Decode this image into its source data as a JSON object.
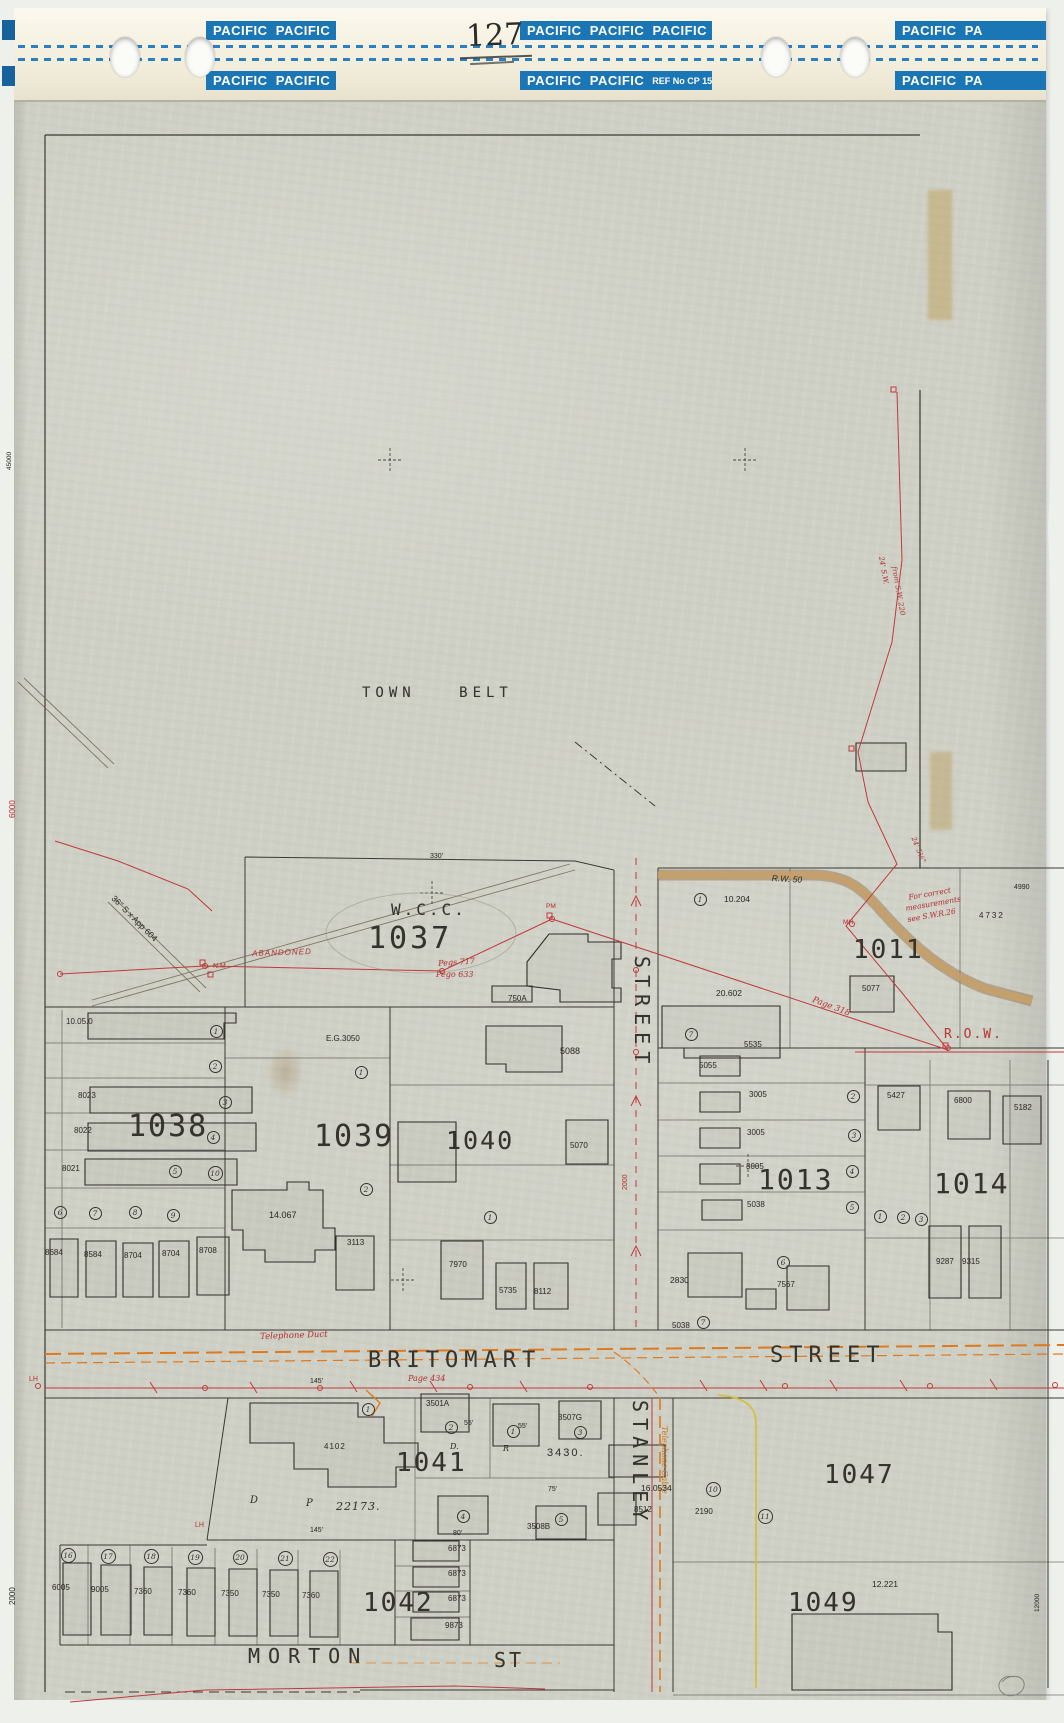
{
  "tape": {
    "page_number": "127",
    "boxes": [
      {
        "label": "PACIFIC  PACIFIC",
        "x": 192,
        "y": 13,
        "w": 130
      },
      {
        "label": "PACIFIC  PACIFIC  PACIFIC",
        "x": 506,
        "y": 13,
        "w": 192
      },
      {
        "label": "PACIFIC  PA",
        "x": 881,
        "y": 13,
        "w": 151
      },
      {
        "label": "PACIFIC  PACIFIC",
        "x": 192,
        "y": 63,
        "w": 130
      },
      {
        "label": "PACIFIC  PACIFIC",
        "x": 506,
        "y": 63,
        "w": 192,
        "ref": "REF No CP 15"
      },
      {
        "label": "PACIFIC  PA",
        "x": 881,
        "y": 63,
        "w": 151
      }
    ]
  },
  "colors": {
    "k": "#34332d",
    "r": "#c0393c",
    "o": "#dd7a20",
    "tape_blue": "#1b76b5",
    "tan_road": "#c7a068",
    "yellow_line": "#d4bf35",
    "paper": "#cfd0c5"
  },
  "map": {
    "labels": [
      {
        "t": "TOWN BELT",
        "x": 362,
        "y": 686,
        "s": 14,
        "f": "m",
        "ls": 5,
        "ws": 30,
        "dn": "region-label-town-belt"
      },
      {
        "t": "W.C.C.",
        "x": 391,
        "y": 902,
        "s": 16,
        "f": "m",
        "ls": 3,
        "dn": "block-label-wcc"
      },
      {
        "t": "1037",
        "x": 368,
        "y": 924,
        "s": 30,
        "f": "m",
        "ls": 3,
        "dn": "block-label-1037"
      },
      {
        "t": "1038",
        "x": 128,
        "y": 1112,
        "s": 30,
        "f": "m",
        "ls": 2,
        "dn": "block-label-1038"
      },
      {
        "t": "1039",
        "x": 314,
        "y": 1122,
        "s": 30,
        "f": "m",
        "ls": 2,
        "dn": "block-label-1039"
      },
      {
        "t": "1040",
        "x": 446,
        "y": 1128,
        "s": 25,
        "f": "m",
        "ls": 2,
        "dn": "block-label-1040"
      },
      {
        "t": "1011",
        "x": 853,
        "y": 937,
        "s": 26,
        "f": "m",
        "ls": 2,
        "dn": "block-label-1011"
      },
      {
        "t": "1013",
        "x": 758,
        "y": 1166,
        "s": 28,
        "f": "m",
        "ls": 2,
        "dn": "block-label-1013"
      },
      {
        "t": "1014",
        "x": 934,
        "y": 1170,
        "s": 28,
        "f": "m",
        "ls": 2,
        "dn": "block-label-1014"
      },
      {
        "t": "1041",
        "x": 396,
        "y": 1450,
        "s": 26,
        "f": "m",
        "ls": 2,
        "dn": "block-label-1041"
      },
      {
        "t": "1047",
        "x": 824,
        "y": 1462,
        "s": 26,
        "f": "m",
        "ls": 2,
        "dn": "block-label-1047"
      },
      {
        "t": "1042",
        "x": 363,
        "y": 1590,
        "s": 26,
        "f": "m",
        "ls": 2,
        "dn": "block-label-1042"
      },
      {
        "t": "1049",
        "x": 788,
        "y": 1590,
        "s": 26,
        "f": "m",
        "ls": 2,
        "dn": "block-label-1049"
      },
      {
        "t": "BRITOMART",
        "x": 368,
        "y": 1350,
        "s": 22,
        "f": "m",
        "ls": 6,
        "dn": "street-label-britomart"
      },
      {
        "t": "STREET",
        "x": 770,
        "y": 1345,
        "s": 22,
        "f": "m",
        "ls": 6,
        "dn": "street-label-britomart-street"
      },
      {
        "t": "STREET",
        "x": 652,
        "y": 956,
        "s": 20,
        "f": "m",
        "ls": 7,
        "r": 90,
        "dn": "street-label-stanley-street-upper"
      },
      {
        "t": "STANLEY",
        "x": 650,
        "y": 1400,
        "s": 20,
        "f": "m",
        "ls": 6,
        "r": 90,
        "dn": "street-label-stanley"
      },
      {
        "t": "MORTON",
        "x": 248,
        "y": 1646,
        "s": 20,
        "f": "m",
        "ls": 8,
        "dn": "street-label-morton"
      },
      {
        "t": "ST",
        "x": 494,
        "y": 1650,
        "s": 20,
        "f": "m",
        "ls": 3,
        "dn": "street-label-morton-st"
      },
      {
        "t": "R.O.W.",
        "x": 944,
        "y": 1028,
        "s": 13,
        "c": "r",
        "f": "m",
        "ls": 2,
        "dn": "row-label"
      },
      {
        "t": "ABANDONED",
        "x": 252,
        "y": 950,
        "s": 8,
        "c": "r",
        "i": 1,
        "ls": 1,
        "r": -2,
        "dn": "annotation-abandoned"
      },
      {
        "t": "Pegs 717",
        "x": 438,
        "y": 960,
        "s": 8,
        "c": "r",
        "i": 1,
        "r": -4,
        "f": "c",
        "dn": "annotation-pegs"
      },
      {
        "t": "Pego 633",
        "x": 436,
        "y": 971,
        "s": 8,
        "c": "r",
        "i": 1,
        "f": "c",
        "dn": "annotation-pego"
      },
      {
        "t": "Page 318",
        "x": 814,
        "y": 996,
        "s": 8.5,
        "c": "r",
        "i": 1,
        "r": 21,
        "f": "c",
        "dn": "annotation-page-318"
      },
      {
        "t": "Page 434",
        "x": 408,
        "y": 1375,
        "s": 8,
        "c": "r",
        "i": 1,
        "f": "c",
        "dn": "annotation-page-434"
      },
      {
        "t": "Telephone Duct",
        "x": 260,
        "y": 1333,
        "s": 8.5,
        "c": "r",
        "i": 1,
        "r": -2,
        "f": "c",
        "dn": "annotation-telephone-duct"
      },
      {
        "t": "Telephone Cable",
        "x": 668,
        "y": 1426,
        "s": 8,
        "c": "o",
        "i": 1,
        "r": 90,
        "f": "c",
        "dn": "annotation-telephone-cable"
      },
      {
        "t": "For correct",
        "x": 908,
        "y": 894,
        "s": 7.5,
        "c": "r",
        "i": 1,
        "r": -10,
        "f": "c",
        "dn": "annotation-note-line1"
      },
      {
        "t": "measurements",
        "x": 905,
        "y": 905,
        "s": 7.5,
        "c": "r",
        "i": 1,
        "r": -10,
        "f": "c",
        "dn": "annotation-note-line2"
      },
      {
        "t": "see S.W.R.26",
        "x": 907,
        "y": 916,
        "s": 7.5,
        "c": "r",
        "i": 1,
        "r": -10,
        "f": "c",
        "dn": "annotation-note-line3"
      },
      {
        "t": "24' 5½\"",
        "x": 916,
        "y": 836,
        "s": 7,
        "c": "r",
        "i": 1,
        "r": 68,
        "f": "c",
        "dn": "annotation-dim"
      },
      {
        "t": "24' S.W.",
        "x": 884,
        "y": 556,
        "s": 7,
        "c": "r",
        "i": 1,
        "r": 80,
        "f": "c",
        "dn": "annotation-dim"
      },
      {
        "t": "from S.W. 220",
        "x": 897,
        "y": 566,
        "s": 7,
        "c": "r",
        "i": 1,
        "r": 80,
        "f": "c",
        "dn": "annotation-dim"
      },
      {
        "t": "N.M",
        "x": 213,
        "y": 963,
        "s": 7,
        "c": "r",
        "dn": "annotation-mark"
      },
      {
        "t": "MH",
        "x": 843,
        "y": 920,
        "s": 6.5,
        "c": "r",
        "dn": "annotation-mark"
      },
      {
        "t": "LH",
        "x": 195,
        "y": 1522,
        "s": 7,
        "c": "r",
        "dn": "annotation-mark"
      },
      {
        "t": "LH",
        "x": 29,
        "y": 1376,
        "s": 7,
        "c": "r",
        "dn": "annotation-mark"
      },
      {
        "t": "PM",
        "x": 546,
        "y": 904,
        "s": 6.5,
        "c": "r",
        "dn": "annotation-mark"
      },
      {
        "t": "6000",
        "x": 9,
        "y": 818,
        "s": 8,
        "c": "r",
        "r": -90,
        "dn": "edge-reference"
      },
      {
        "t": "2000",
        "x": 9,
        "y": 1605,
        "s": 8,
        "r": -90,
        "dn": "edge-reference"
      },
      {
        "t": "2000",
        "x": 622,
        "y": 1190,
        "s": 7,
        "c": "r",
        "r": -90,
        "dn": "edge-reference"
      },
      {
        "t": "45000",
        "x": 7,
        "y": 470,
        "s": 6.5,
        "r": -90,
        "dn": "edge-reference"
      },
      {
        "t": "12000",
        "x": 1035,
        "y": 1612,
        "s": 6.5,
        "r": -90,
        "dn": "edge-reference"
      },
      {
        "t": "36\" S x App 604",
        "x": 116,
        "y": 894,
        "s": 8.5,
        "r": 45,
        "dn": "annotation-pipe"
      },
      {
        "t": "R.W. 50",
        "x": 772,
        "y": 874,
        "s": 8.5,
        "i": 1,
        "r": 3,
        "dn": "annotation-rw50"
      },
      {
        "t": "330'",
        "x": 430,
        "y": 853,
        "s": 7,
        "dn": "dimension"
      },
      {
        "t": "10.05.0",
        "x": 66,
        "y": 1018,
        "s": 8,
        "dn": "parcel-area"
      },
      {
        "t": "8023",
        "x": 78,
        "y": 1092,
        "s": 8,
        "dn": "house-number"
      },
      {
        "t": "8022",
        "x": 74,
        "y": 1127,
        "s": 8,
        "dn": "house-number"
      },
      {
        "t": "8021",
        "x": 62,
        "y": 1165,
        "s": 8,
        "dn": "house-number"
      },
      {
        "t": "8684",
        "x": 45,
        "y": 1249,
        "s": 8,
        "dn": "house-number"
      },
      {
        "t": "8584",
        "x": 84,
        "y": 1251,
        "s": 8,
        "dn": "house-number"
      },
      {
        "t": "8704",
        "x": 124,
        "y": 1252,
        "s": 8,
        "dn": "house-number"
      },
      {
        "t": "8704",
        "x": 162,
        "y": 1250,
        "s": 8,
        "dn": "house-number"
      },
      {
        "t": "8708",
        "x": 199,
        "y": 1247,
        "s": 8,
        "dn": "house-number"
      },
      {
        "t": "E.G.3050",
        "x": 326,
        "y": 1035,
        "s": 8,
        "dn": "house-number"
      },
      {
        "t": "14.067",
        "x": 269,
        "y": 1211,
        "s": 9,
        "dn": "parcel-area"
      },
      {
        "t": "3113",
        "x": 347,
        "y": 1239,
        "s": 8,
        "dn": "house-number"
      },
      {
        "t": "7970",
        "x": 449,
        "y": 1261,
        "s": 8,
        "dn": "house-number"
      },
      {
        "t": "750A",
        "x": 508,
        "y": 995,
        "s": 8,
        "dn": "house-number"
      },
      {
        "t": "5088",
        "x": 560,
        "y": 1047,
        "s": 9,
        "dn": "house-number"
      },
      {
        "t": "5070",
        "x": 570,
        "y": 1142,
        "s": 8,
        "dn": "house-number"
      },
      {
        "t": "5735",
        "x": 499,
        "y": 1287,
        "s": 8,
        "dn": "house-number"
      },
      {
        "t": "8112",
        "x": 534,
        "y": 1288,
        "s": 8,
        "dn": "house-number"
      },
      {
        "t": "10.204",
        "x": 724,
        "y": 895,
        "s": 8.5,
        "dn": "parcel-area"
      },
      {
        "t": "20.602",
        "x": 716,
        "y": 989,
        "s": 8.5,
        "dn": "parcel-area"
      },
      {
        "t": "5077",
        "x": 862,
        "y": 985,
        "s": 8,
        "dn": "house-number"
      },
      {
        "t": "4732",
        "x": 979,
        "y": 912,
        "s": 8,
        "ls": 2,
        "dn": "house-number"
      },
      {
        "t": "4990",
        "x": 1014,
        "y": 884,
        "s": 7,
        "dn": "edge-reference"
      },
      {
        "t": "5535",
        "x": 744,
        "y": 1041,
        "s": 8,
        "dn": "house-number"
      },
      {
        "t": "5055",
        "x": 699,
        "y": 1062,
        "s": 8,
        "dn": "house-number"
      },
      {
        "t": "3005",
        "x": 749,
        "y": 1091,
        "s": 8,
        "dn": "house-number"
      },
      {
        "t": "3005",
        "x": 747,
        "y": 1129,
        "s": 8,
        "dn": "house-number"
      },
      {
        "t": "3005",
        "x": 746,
        "y": 1163,
        "s": 8,
        "dn": "house-number"
      },
      {
        "t": "5038",
        "x": 747,
        "y": 1201,
        "s": 8,
        "dn": "house-number"
      },
      {
        "t": "2830",
        "x": 670,
        "y": 1276,
        "s": 8.5,
        "dn": "house-number"
      },
      {
        "t": "5038",
        "x": 672,
        "y": 1322,
        "s": 8,
        "dn": "house-number"
      },
      {
        "t": "5427",
        "x": 887,
        "y": 1092,
        "s": 8,
        "dn": "house-number"
      },
      {
        "t": "6800",
        "x": 954,
        "y": 1097,
        "s": 8,
        "dn": "house-number"
      },
      {
        "t": "5182",
        "x": 1014,
        "y": 1104,
        "s": 8,
        "dn": "house-number"
      },
      {
        "t": "9287",
        "x": 936,
        "y": 1258,
        "s": 8,
        "dn": "house-number"
      },
      {
        "t": "9315",
        "x": 962,
        "y": 1258,
        "s": 8,
        "dn": "house-number"
      },
      {
        "t": "7567",
        "x": 777,
        "y": 1281,
        "s": 8,
        "dn": "house-number"
      },
      {
        "t": "4102",
        "x": 324,
        "y": 1443,
        "s": 8,
        "ls": 1,
        "dn": "house-number"
      },
      {
        "t": "3501A",
        "x": 426,
        "y": 1400,
        "s": 8,
        "dn": "house-number"
      },
      {
        "t": "3507G",
        "x": 558,
        "y": 1414,
        "s": 8,
        "dn": "house-number"
      },
      {
        "t": "3430.",
        "x": 547,
        "y": 1448,
        "s": 11,
        "ls": 2,
        "dn": "house-number"
      },
      {
        "t": "3508B",
        "x": 527,
        "y": 1523,
        "s": 8,
        "dn": "house-number"
      },
      {
        "t": "D",
        "x": 250,
        "y": 1496,
        "s": 10,
        "i": 1,
        "f": "c",
        "dn": "plan-letter"
      },
      {
        "t": "P",
        "x": 306,
        "y": 1499,
        "s": 10,
        "i": 1,
        "f": "c",
        "dn": "plan-letter"
      },
      {
        "t": "22173.",
        "x": 336,
        "y": 1501,
        "s": 11,
        "i": 1,
        "ls": 1,
        "f": "c",
        "dn": "plan-number"
      },
      {
        "t": "D.",
        "x": 450,
        "y": 1443,
        "s": 8,
        "i": 1,
        "f": "c",
        "dn": "plan-letter"
      },
      {
        "t": "R",
        "x": 503,
        "y": 1445,
        "s": 8,
        "i": 1,
        "f": "c",
        "dn": "plan-letter"
      },
      {
        "t": "145'",
        "x": 310,
        "y": 1378,
        "s": 7,
        "dn": "dimension"
      },
      {
        "t": "145'",
        "x": 310,
        "y": 1527,
        "s": 7,
        "dn": "dimension"
      },
      {
        "t": "80'",
        "x": 453,
        "y": 1530,
        "s": 7,
        "dn": "dimension"
      },
      {
        "t": "75'",
        "x": 548,
        "y": 1486,
        "s": 7,
        "dn": "dimension"
      },
      {
        "t": "55'",
        "x": 464,
        "y": 1420,
        "s": 7,
        "dn": "dimension"
      },
      {
        "t": "55'",
        "x": 518,
        "y": 1423,
        "s": 7,
        "dn": "dimension"
      },
      {
        "t": "16.0534",
        "x": 641,
        "y": 1484,
        "s": 8.5,
        "dn": "parcel-area"
      },
      {
        "t": "8512",
        "x": 634,
        "y": 1506,
        "s": 8,
        "dn": "house-number"
      },
      {
        "t": "2190",
        "x": 695,
        "y": 1508,
        "s": 8,
        "dn": "house-number"
      },
      {
        "t": "12.221",
        "x": 872,
        "y": 1580,
        "s": 8.5,
        "dn": "parcel-area"
      },
      {
        "t": "6005",
        "x": 52,
        "y": 1584,
        "s": 8,
        "dn": "house-number"
      },
      {
        "t": "9005",
        "x": 91,
        "y": 1586,
        "s": 8,
        "dn": "house-number"
      },
      {
        "t": "7360",
        "x": 134,
        "y": 1588,
        "s": 8,
        "dn": "house-number"
      },
      {
        "t": "7360",
        "x": 178,
        "y": 1589,
        "s": 8,
        "dn": "house-number"
      },
      {
        "t": "7350",
        "x": 221,
        "y": 1590,
        "s": 8,
        "dn": "house-number"
      },
      {
        "t": "7350",
        "x": 262,
        "y": 1591,
        "s": 8,
        "dn": "house-number"
      },
      {
        "t": "7360",
        "x": 302,
        "y": 1592,
        "s": 8,
        "dn": "house-number"
      },
      {
        "t": "6873",
        "x": 448,
        "y": 1545,
        "s": 8,
        "dn": "house-number"
      },
      {
        "t": "6873",
        "x": 448,
        "y": 1570,
        "s": 8,
        "dn": "house-number"
      },
      {
        "t": "6873",
        "x": 448,
        "y": 1595,
        "s": 8,
        "dn": "house-number"
      },
      {
        "t": "9873",
        "x": 445,
        "y": 1622,
        "s": 8,
        "dn": "house-number"
      }
    ],
    "lot_circles": [
      {
        "n": "1",
        "x": 216,
        "y": 1031
      },
      {
        "n": "2",
        "x": 215,
        "y": 1066
      },
      {
        "n": "3",
        "x": 225,
        "y": 1102
      },
      {
        "n": "4",
        "x": 213,
        "y": 1137
      },
      {
        "n": "5",
        "x": 175,
        "y": 1171
      },
      {
        "n": "10",
        "x": 215,
        "y": 1173
      },
      {
        "n": "6",
        "x": 60,
        "y": 1212
      },
      {
        "n": "7",
        "x": 95,
        "y": 1213
      },
      {
        "n": "8",
        "x": 135,
        "y": 1212
      },
      {
        "n": "9",
        "x": 173,
        "y": 1215
      },
      {
        "n": "1",
        "x": 361,
        "y": 1072
      },
      {
        "n": "2",
        "x": 366,
        "y": 1189
      },
      {
        "n": "1",
        "x": 490,
        "y": 1217
      },
      {
        "n": "1",
        "x": 700,
        "y": 899
      },
      {
        "n": "7",
        "x": 691,
        "y": 1034
      },
      {
        "n": "2",
        "x": 853,
        "y": 1096
      },
      {
        "n": "3",
        "x": 854,
        "y": 1135
      },
      {
        "n": "4",
        "x": 852,
        "y": 1171
      },
      {
        "n": "5",
        "x": 852,
        "y": 1207
      },
      {
        "n": "6",
        "x": 783,
        "y": 1262
      },
      {
        "n": "7",
        "x": 703,
        "y": 1322
      },
      {
        "n": "1",
        "x": 880,
        "y": 1216
      },
      {
        "n": "2",
        "x": 903,
        "y": 1217
      },
      {
        "n": "3",
        "x": 921,
        "y": 1219
      },
      {
        "n": "1",
        "x": 368,
        "y": 1409
      },
      {
        "n": "2",
        "x": 451,
        "y": 1427
      },
      {
        "n": "1",
        "x": 513,
        "y": 1431
      },
      {
        "n": "3",
        "x": 580,
        "y": 1432
      },
      {
        "n": "4",
        "x": 463,
        "y": 1516
      },
      {
        "n": "5",
        "x": 561,
        "y": 1519
      },
      {
        "n": "10",
        "x": 713,
        "y": 1489
      },
      {
        "n": "11",
        "x": 765,
        "y": 1516
      },
      {
        "n": "16",
        "x": 68,
        "y": 1555
      },
      {
        "n": "17",
        "x": 108,
        "y": 1556
      },
      {
        "n": "18",
        "x": 151,
        "y": 1556
      },
      {
        "n": "19",
        "x": 195,
        "y": 1557
      },
      {
        "n": "20",
        "x": 240,
        "y": 1557
      },
      {
        "n": "21",
        "x": 285,
        "y": 1558
      },
      {
        "n": "22",
        "x": 330,
        "y": 1559
      }
    ]
  }
}
